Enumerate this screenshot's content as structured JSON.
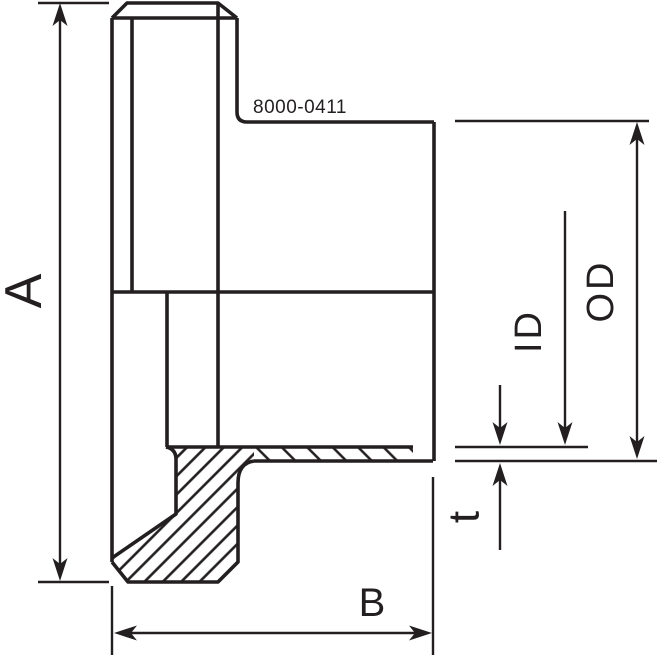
{
  "drawing": {
    "part_number": "8000-0411",
    "dimension_labels": {
      "overall_length": "A",
      "body_length": "B",
      "inner_diameter": "ID",
      "outer_diameter": "OD",
      "wall_thickness": "t"
    },
    "colors": {
      "line": "#231f20",
      "background": "#ffffff"
    }
  }
}
